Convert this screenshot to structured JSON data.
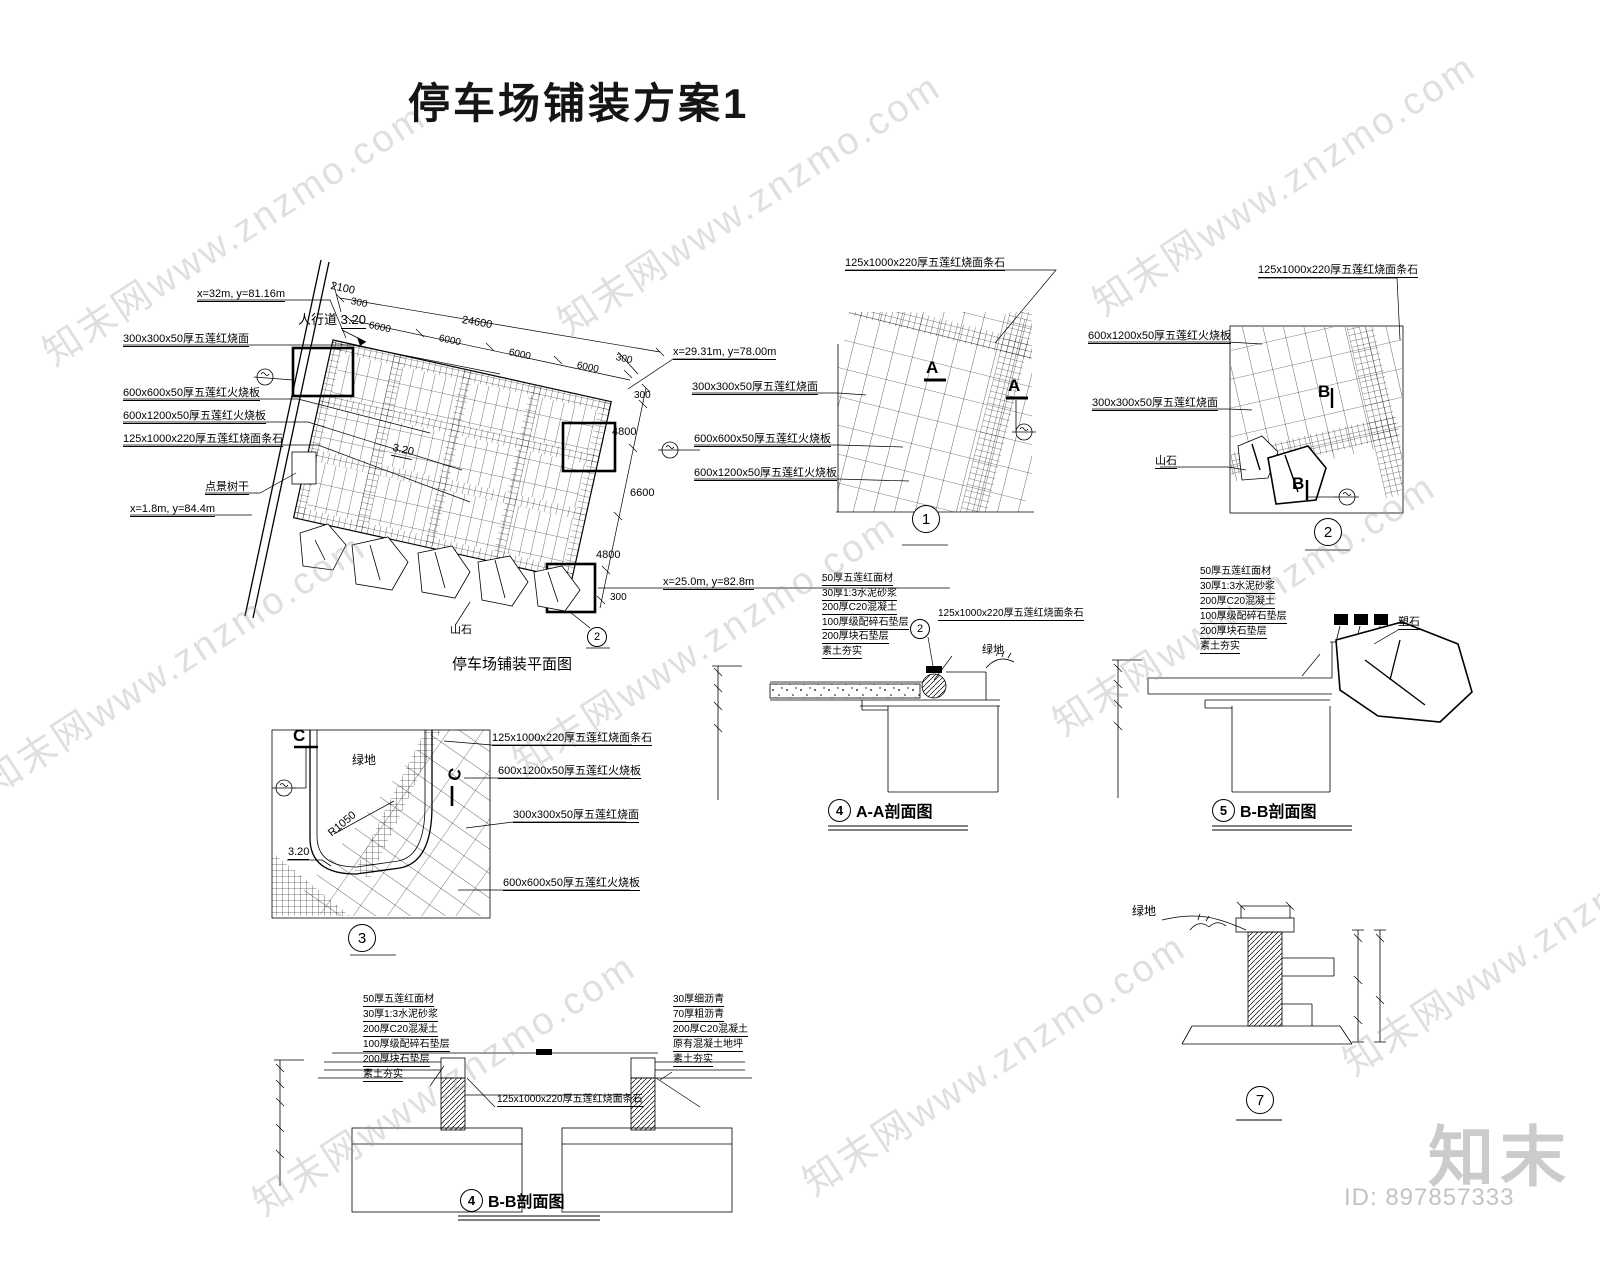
{
  "title": "停车场铺装方案1",
  "watermark": {
    "tile": "知末网www.znzmo.com",
    "logo": "知末",
    "id": "ID: 897857333"
  },
  "materials": {
    "m300": "300x300x50厚五莲红烧面",
    "m600": "600x600x50厚五莲红火烧板",
    "m1200": "600x1200x50厚五莲红火烧板",
    "strip": "125x1000x220厚五莲红烧面条石"
  },
  "markers": {
    "a": "A",
    "b": "B",
    "c": "C"
  },
  "plan": {
    "caption": "停车场铺装平面图",
    "coord_top": "x=32m, y=81.16m",
    "coord_right": "x=29.31m, y=78.00m",
    "coord_bottom": "x=25.0m, y=82.8m",
    "coord_left": "x=1.8m, y=84.4m",
    "sidewalk": "人行道",
    "level": "3.20",
    "tree_label": "点景树干",
    "rock_label": "山石",
    "detail_ref": "2",
    "dims": {
      "d2100": "2100",
      "d300": "300",
      "d24600": "24600",
      "d6000": "6000",
      "d4800": "4800",
      "d6600": "6600"
    }
  },
  "layers": {
    "base": [
      "50厚五莲红面材",
      "30厚1:3水泥砂浆",
      "200厚C20混凝土",
      "100厚级配碎石垫层",
      "200厚块石垫层",
      "素土夯实"
    ],
    "asphalt": [
      "30厚细沥青",
      "70厚粗沥青",
      "200厚C20混凝土",
      "原有混凝土地坪",
      "素土夯实"
    ]
  },
  "details": {
    "d1": {
      "num": "1"
    },
    "d2": {
      "num": "2",
      "rock_label": "山石"
    },
    "d3": {
      "num": "3",
      "green": "绿地",
      "radius": "R1050",
      "level": "3.20"
    },
    "d4": {
      "num": "4",
      "caption": "A-A剖面图",
      "green": "绿地",
      "ref": "2"
    },
    "d5": {
      "num": "5",
      "caption": "B-B剖面图",
      "rock_label": "塑石"
    },
    "d6": {
      "num": "4",
      "caption": "B-B剖面图"
    },
    "d7": {
      "num": "7",
      "green": "绿地"
    }
  }
}
